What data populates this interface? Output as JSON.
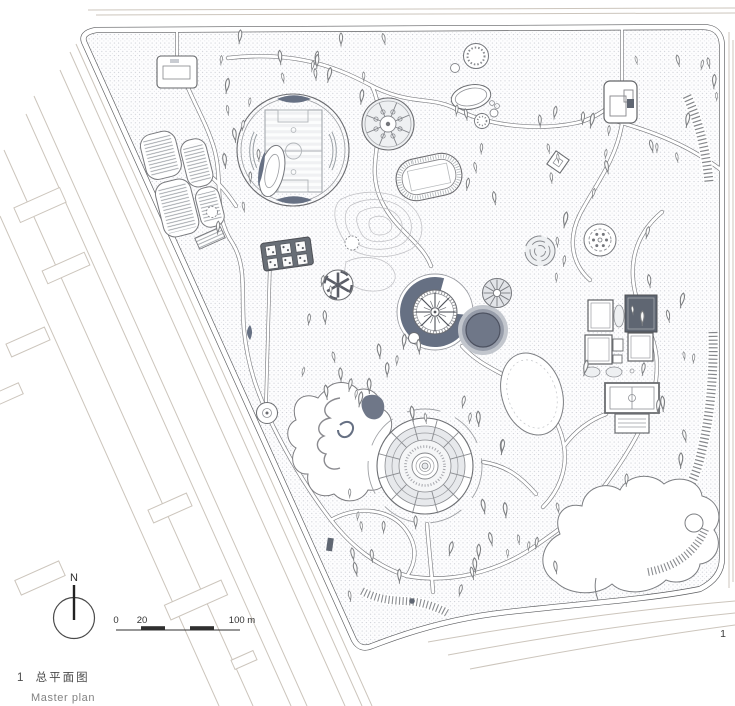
{
  "figure": {
    "number": "1",
    "caption_zh": "总平面图",
    "caption_en": "Master plan",
    "page_number": "1"
  },
  "north_arrow": {
    "label": "N"
  },
  "scale_bar": {
    "labels": [
      "0",
      "20",
      "100 m"
    ]
  },
  "colors": {
    "paper": "#ffffff",
    "ink": "#5f6165",
    "context_gray": "#ccc5bc",
    "stipple_dot": "#c6c9d0",
    "dark_fill": "#667083",
    "pond_core": "#6f7788",
    "dark_roof": "#5f6672"
  }
}
